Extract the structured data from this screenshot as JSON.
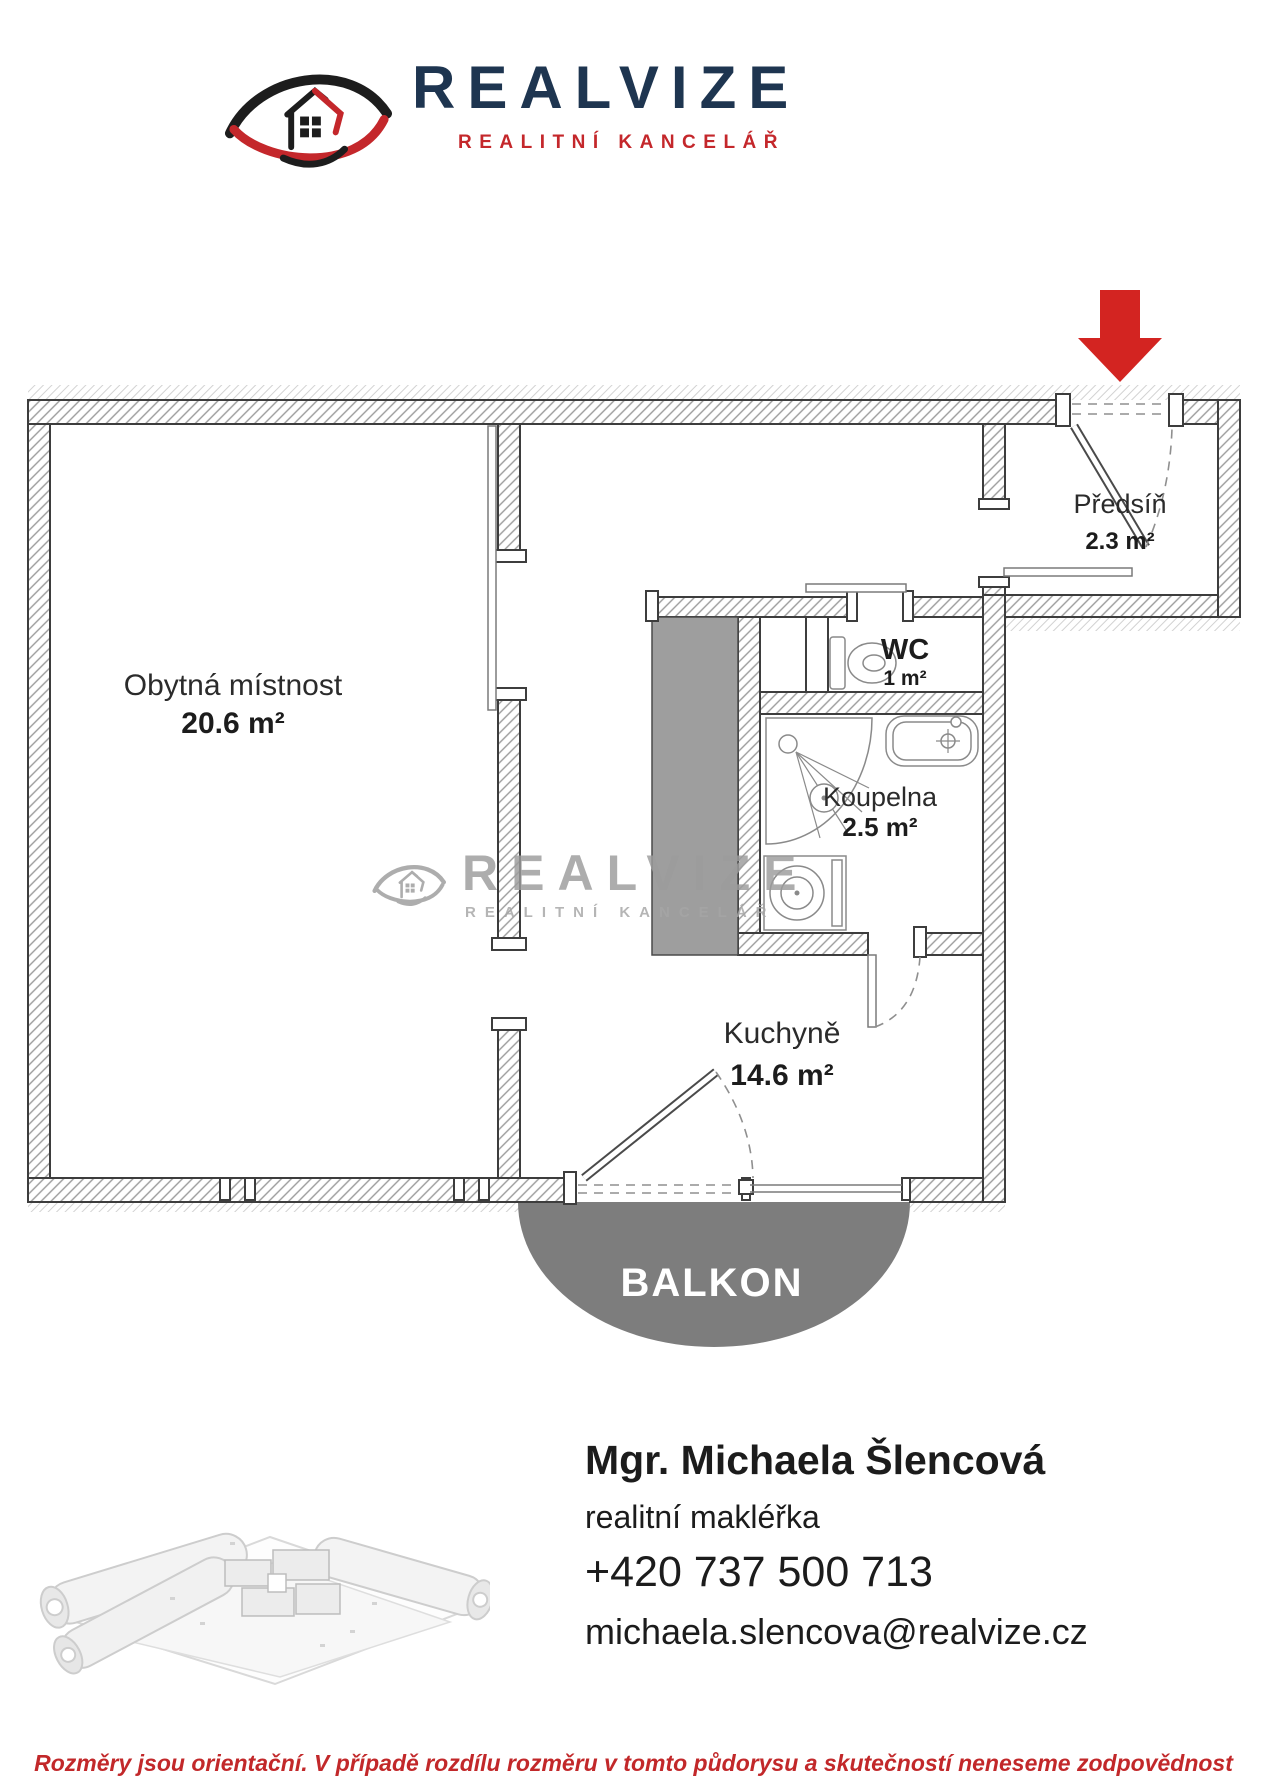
{
  "brand": {
    "name": "REALVIZE",
    "tagline": "REALITNÍ KANCELÁŘ",
    "navy_color": "#1e3550",
    "red_color": "#c4272b"
  },
  "icons": {
    "logo": "eye-with-house-icon",
    "entrance_arrow": "red-arrow-down-icon"
  },
  "floorplan": {
    "rooms": [
      {
        "name": "Obytná místnost",
        "area": "20.6 m²"
      },
      {
        "name": "Předsíň",
        "area": "2.3 m²"
      },
      {
        "name": "WC",
        "area": "1 m²"
      },
      {
        "name": "Koupelna",
        "area": "2.5 m²"
      },
      {
        "name": "Kuchyně",
        "area": "14.6 m²"
      }
    ],
    "balcony_label": "BALKON",
    "balcony_color": "#7d7d7d",
    "shaft_color": "#9e9e9e",
    "entrance_arrow_color": "#d32421"
  },
  "watermark": {
    "name": "REALVIZE",
    "tagline": "REALITNÍ KANCELÁŘ",
    "color": "#9c9c9c"
  },
  "agent": {
    "name": "Mgr. Michaela Šlencová",
    "role": "realitní makléřka",
    "phone": "+420 737 500 713",
    "email": "michaela.slencova@realvize.cz"
  },
  "disclaimer": "Rozměry jsou orientační. V případě rozdílu rozměru v tomto půdorysu a skutečností neneseme zodpovědnost"
}
